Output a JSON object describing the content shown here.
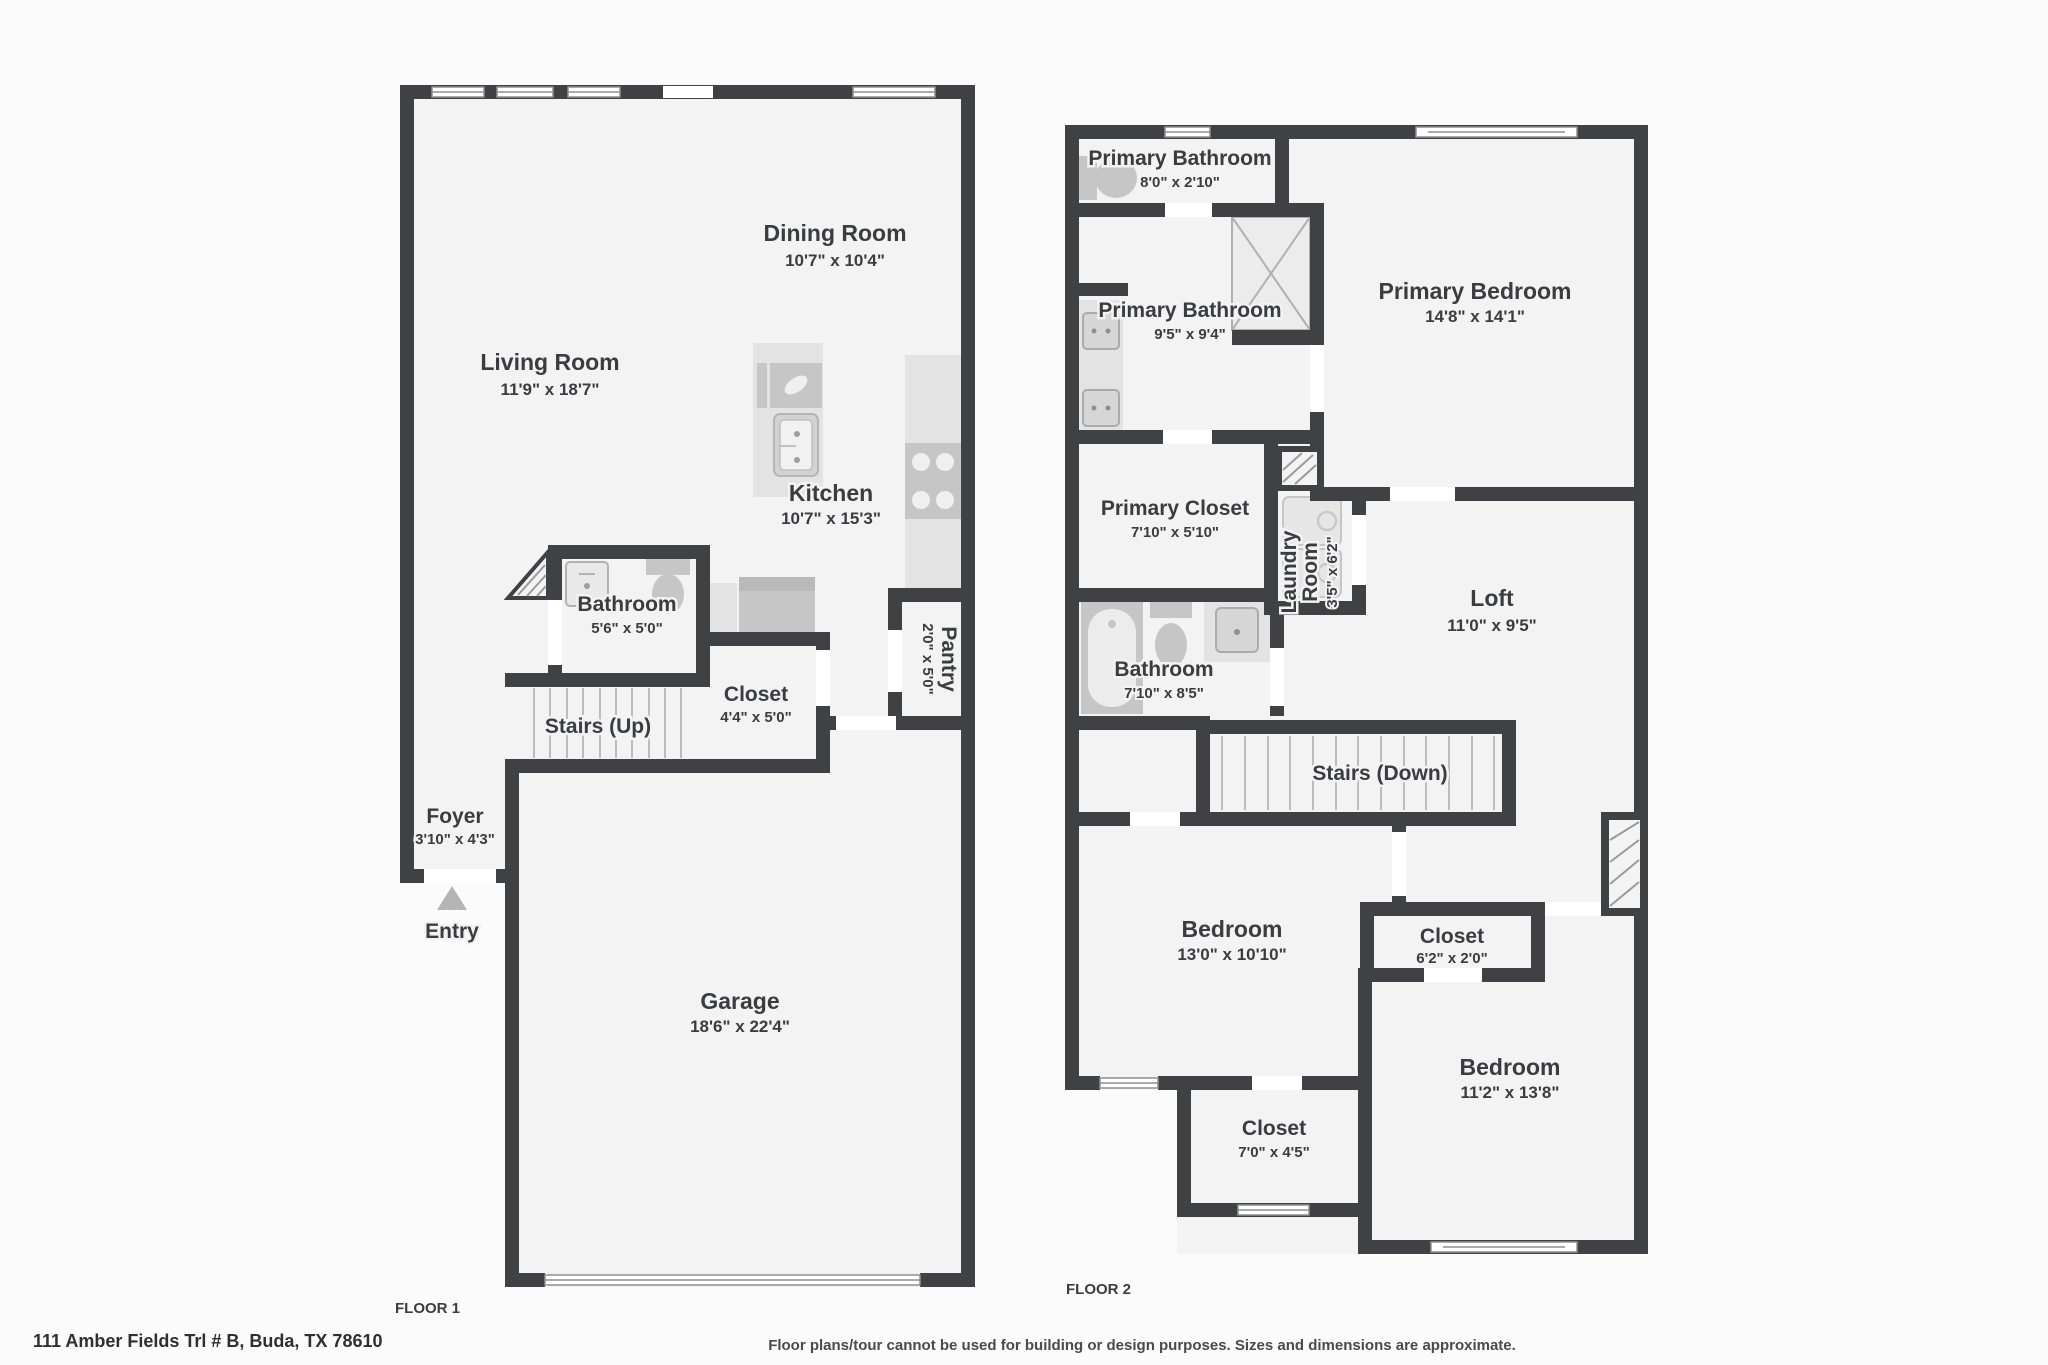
{
  "page": {
    "floor1_label": "FLOOR 1",
    "floor2_label": "FLOOR 2",
    "address": "111 Amber Fields Trl # B, Buda, TX 78610",
    "disclaimer": "Floor plans/tour cannot be used for building or design purposes. Sizes and dimensions are approximate."
  },
  "floor1": {
    "rooms": {
      "dining": {
        "name": "Dining Room",
        "dims": "10'7\" x 10'4\""
      },
      "living": {
        "name": "Living Room",
        "dims": "11'9\" x 18'7\""
      },
      "kitchen": {
        "name": "Kitchen",
        "dims": "10'7\" x 15'3\""
      },
      "bathroom": {
        "name": "Bathroom",
        "dims": "5'6\" x 5'0\""
      },
      "stairs": {
        "name": "Stairs (Up)"
      },
      "closet": {
        "name": "Closet",
        "dims": "4'4\" x 5'0\""
      },
      "pantry": {
        "name": "Pantry",
        "dims": "2'0\" x 5'0\""
      },
      "foyer": {
        "name": "Foyer",
        "dims": "3'10\" x 4'3\""
      },
      "entry": {
        "name": "Entry"
      },
      "garage": {
        "name": "Garage",
        "dims": "18'6\" x 22'4\""
      }
    }
  },
  "floor2": {
    "rooms": {
      "primary_bathroom_upper": {
        "name": "Primary Bathroom",
        "dims": "8'0\" x 2'10\""
      },
      "primary_bathroom": {
        "name": "Primary Bathroom",
        "dims": "9'5\" x 9'4\""
      },
      "primary_bedroom": {
        "name": "Primary Bedroom",
        "dims": "14'8\" x 14'1\""
      },
      "primary_closet": {
        "name": "Primary Closet",
        "dims": "7'10\" x 5'10\""
      },
      "laundry": {
        "name_line1": "Laundry",
        "name_line2": "Room",
        "dims": "3'5\" x 6'2\""
      },
      "loft": {
        "name": "Loft",
        "dims": "11'0\" x 9'5\""
      },
      "bathroom": {
        "name": "Bathroom",
        "dims": "7'10\" x 8'5\""
      },
      "stairs": {
        "name": "Stairs (Down)"
      },
      "bedroom_left": {
        "name": "Bedroom",
        "dims": "13'0\" x 10'10\""
      },
      "closet_small": {
        "name": "Closet",
        "dims": "6'2\" x 2'0\""
      },
      "bedroom_right": {
        "name": "Bedroom",
        "dims": "11'2\" x 13'8\""
      },
      "closet_lower": {
        "name": "Closet",
        "dims": "7'0\" x 4'5\""
      }
    }
  }
}
